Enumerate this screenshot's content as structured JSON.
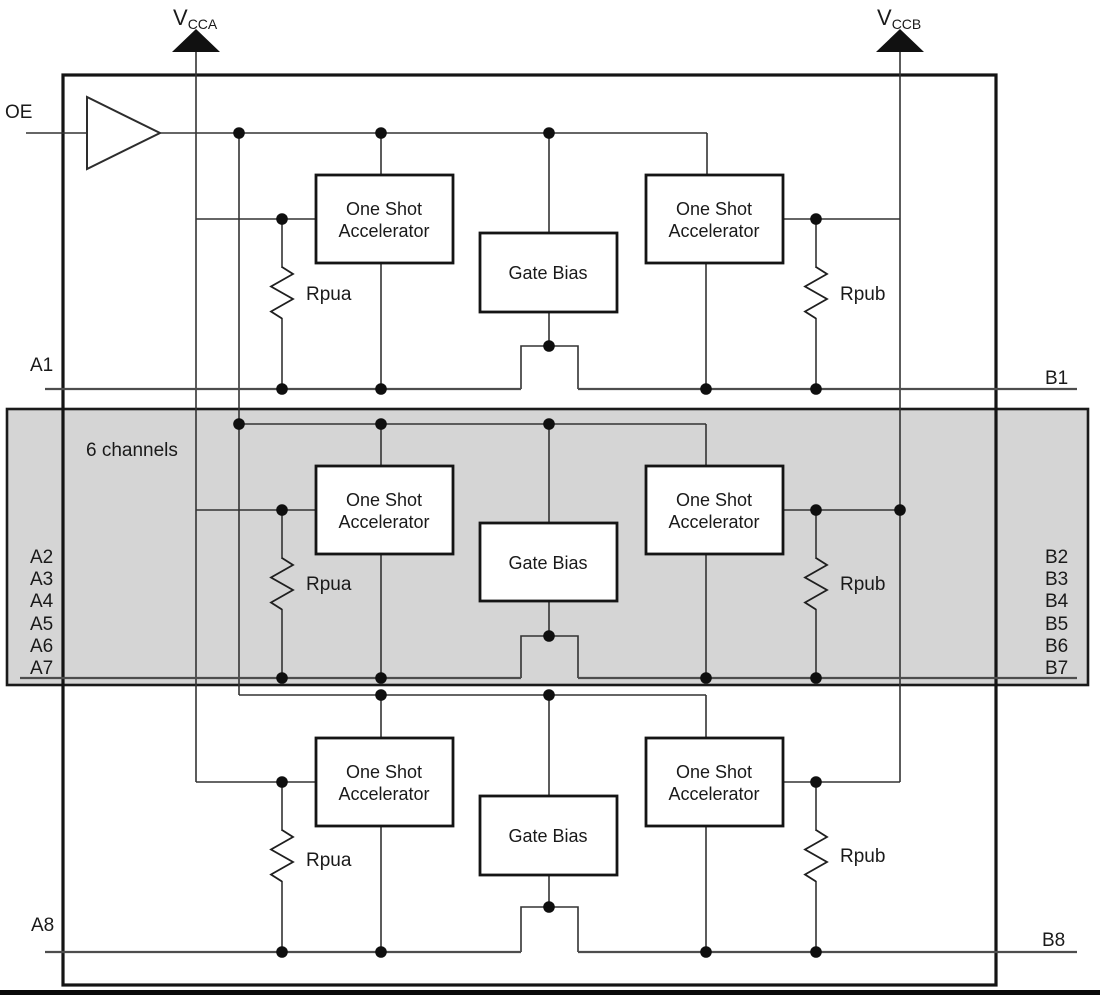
{
  "labels": {
    "oe": "OE",
    "vcca": {
      "main": "V",
      "sub": "CCA"
    },
    "vccb": {
      "main": "V",
      "sub": "CCB"
    },
    "six_channels": "6 channels",
    "one_shot_line1": "One Shot",
    "one_shot_line2": "Accelerator",
    "gate_bias": "Gate Bias",
    "rpua": "Rpua",
    "rpub": "Rpub",
    "a1": "A1",
    "b1": "B1",
    "a8": "A8",
    "b8": "B8",
    "a_group": [
      "A2",
      "A3",
      "A4",
      "A5",
      "A6",
      "A7"
    ],
    "b_group": [
      "B2",
      "B3",
      "B4",
      "B5",
      "B6",
      "B7"
    ]
  },
  "colors": {
    "wire": "#333333",
    "outline": "#141414",
    "shade_fill": "#d5d5d5",
    "text": "#1a1a1a",
    "background": "#ffffff"
  }
}
